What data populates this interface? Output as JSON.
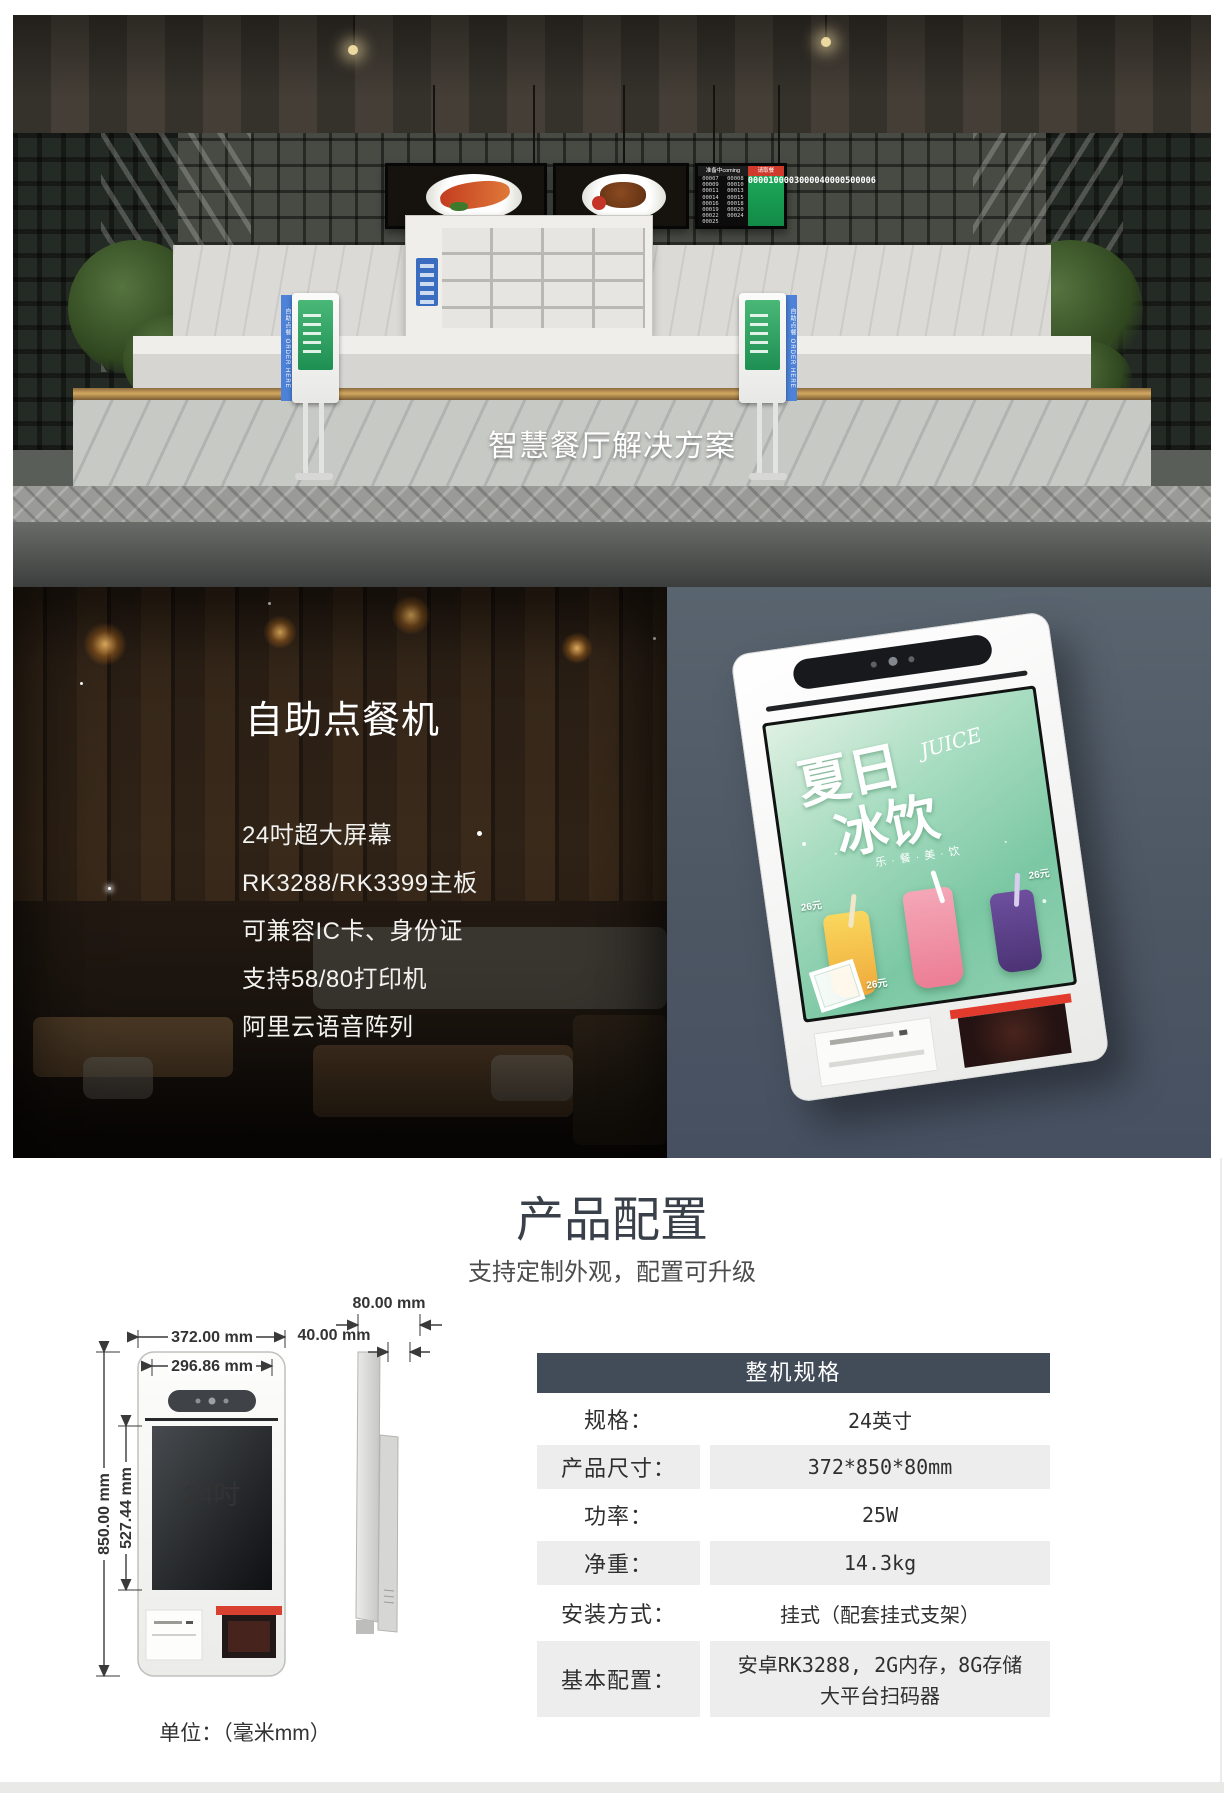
{
  "banner": {
    "title": "智慧餐厅解决方案",
    "kiosk_label": "自助点餐 ORDER HERE",
    "queue_board": {
      "preparing_label": "准备中coming",
      "ready_label": "请取餐",
      "preparing_numbers": [
        "00007",
        "00008",
        "00009",
        "00010",
        "00011",
        "00013",
        "00014",
        "00015",
        "00016",
        "00018",
        "00019",
        "00020",
        "00022",
        "00024",
        "00025"
      ],
      "ready_numbers": [
        "00001",
        "00003",
        "00004",
        "00005",
        "00006"
      ]
    }
  },
  "intro": {
    "heading": "自助点餐机",
    "features": [
      "24吋超大屏幕",
      "RK3288/RK3399主板",
      "可兼容IC卡、身份证",
      "支持58/80打印机",
      "阿里云语音阵列"
    ],
    "kiosk_ad": {
      "title_top": "夏日",
      "title_bottom": "冰饮",
      "script_word": "JUICE",
      "tagline": "乐·餐·美·饮",
      "price_left": "26元",
      "price_right": "26元",
      "price_bottom": "26元"
    }
  },
  "config": {
    "title": "产品配置",
    "subtitle": "支持定制外观，配置可升级",
    "drawing": {
      "dim_width_outer": "372.00 mm",
      "dim_width_inner": "296.86 mm",
      "dim_height_outer": "850.00 mm",
      "dim_height_screen": "527.44 mm",
      "dim_depth_outer": "80.00 mm",
      "dim_depth_front": "40.00 mm",
      "screen_size_label": "24吋",
      "unit_note": "单位：（毫米mm）"
    },
    "spec_table": {
      "header": "整机规格",
      "rows": [
        {
          "label": "规格：",
          "value": "24英寸"
        },
        {
          "label": "产品尺寸：",
          "value": "372*850*80mm"
        },
        {
          "label": "功率：",
          "value": "25W"
        },
        {
          "label": "净重：",
          "value": "14.3kg"
        },
        {
          "label": "安装方式：",
          "value": "挂式（配套挂式支架）"
        },
        {
          "label": "基本配置：",
          "value": "安卓RK3288, 2G内存，8G存储",
          "value2": "大平台扫码器"
        }
      ]
    }
  }
}
